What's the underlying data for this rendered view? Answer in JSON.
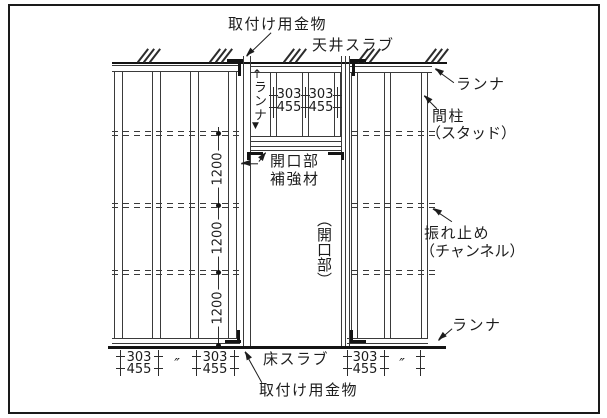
{
  "labels": {
    "mounting_hardware_top": "取付け用金物",
    "ceiling_slab": "天井スラブ",
    "runner_top_right": "ランナ",
    "stud": "間柱",
    "stud_sub": "（スタッド）",
    "spandrel_runner": "ランナ",
    "opening_reinforcement_1": "開口部",
    "opening_reinforcement_2": "補強材",
    "opening": "（開口部）",
    "bracing": "振れ止め",
    "bracing_sub": "（チャンネル）",
    "runner_bottom_right": "ランナ",
    "floor_slab": "床スラブ",
    "mounting_hardware_bottom": "取付け用金物"
  },
  "dimensions": {
    "vertical": [
      "1200",
      "1200",
      "1200"
    ],
    "spandrel": [
      {
        "top": "303",
        "bottom": "455"
      },
      {
        "top": "303",
        "bottom": "455"
      }
    ],
    "bottom_left": [
      {
        "top": "303",
        "bottom": "455"
      },
      {
        "ditto": "″"
      },
      {
        "top": "303",
        "bottom": "455"
      }
    ],
    "bottom_right": [
      {
        "top": "303",
        "bottom": "455"
      },
      {
        "ditto": "″"
      }
    ]
  },
  "icons": {
    "up_arrow": "↑",
    "down_arrow": "▼"
  },
  "colors": {
    "background": "#ffffff",
    "line": "#3a3a3a",
    "thick_line": "#141414",
    "text": "#1c1c1c"
  }
}
